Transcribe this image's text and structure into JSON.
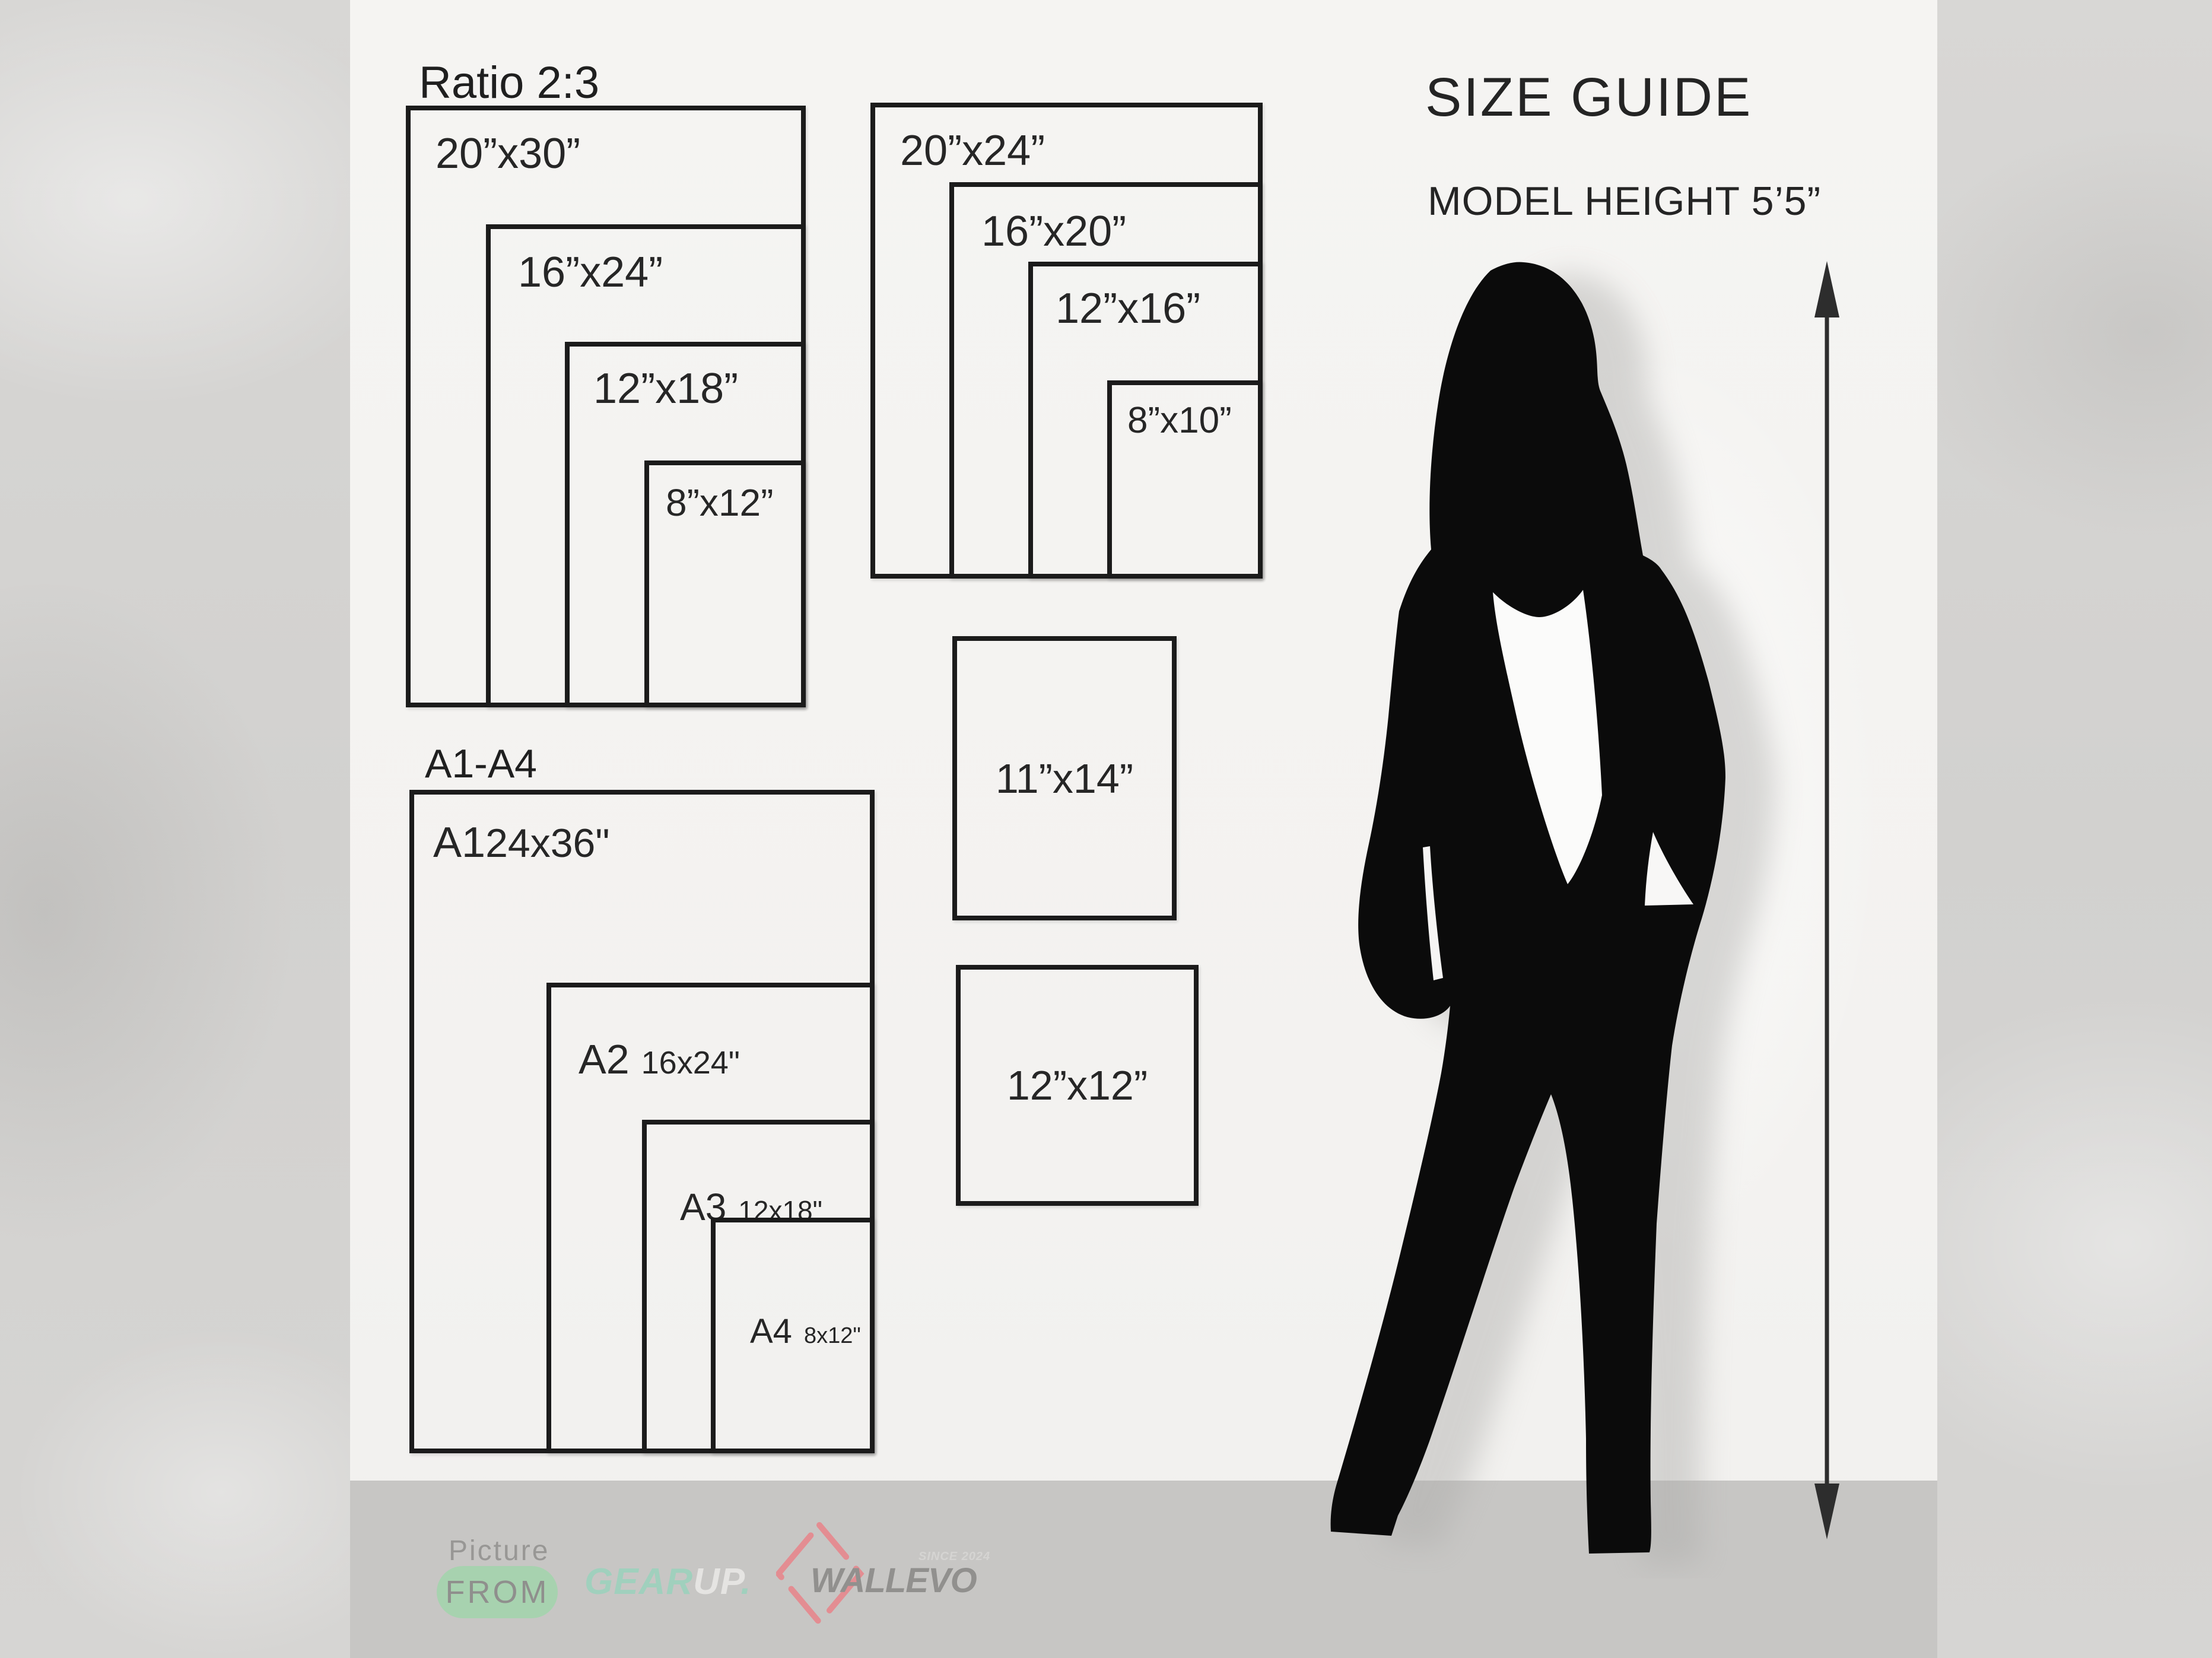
{
  "title": "SIZE GUIDE",
  "subtitle": "MODEL HEIGHT 5’5”",
  "groups": {
    "ratio23": {
      "heading": "Ratio 2:3",
      "rects": [
        {
          "label": "20”x30”"
        },
        {
          "label": "16”x24”"
        },
        {
          "label": "12”x18”"
        },
        {
          "label": "8”x12”"
        }
      ]
    },
    "standard": {
      "rects": [
        {
          "label": "20”x24”"
        },
        {
          "label": "16”x20”"
        },
        {
          "label": "12”x16”"
        },
        {
          "label": "8”x10”"
        }
      ]
    },
    "a_series": {
      "heading": "A1-A4",
      "rects": [
        {
          "name": "A1",
          "size": "24x36\""
        },
        {
          "name": "A2",
          "size": "16x24\""
        },
        {
          "name": "A3",
          "size": "12x18\""
        },
        {
          "name": "A4",
          "size": "8x12\""
        }
      ]
    },
    "singles": [
      {
        "label": "11”x14”"
      },
      {
        "label": "12”x12”"
      }
    ]
  },
  "footer": {
    "picture_label": "Picture",
    "from_label": "FROM",
    "gearup": {
      "gear": "GEAR",
      "up": "UP",
      "dot": "."
    },
    "wallevo": {
      "name": "WALLEVO",
      "since": "SINCE 2024"
    }
  },
  "colors": {
    "panel": "#f4f3f1",
    "outer_wall": "#d5d4d2",
    "footer_strip": "#c7c6c4",
    "line_black": "#1b1b1b",
    "accent_green": "#a5d4ae",
    "accent_teal": "#9ed1bd",
    "accent_red": "#e58b90",
    "silhouette": "#0b0b0b"
  }
}
